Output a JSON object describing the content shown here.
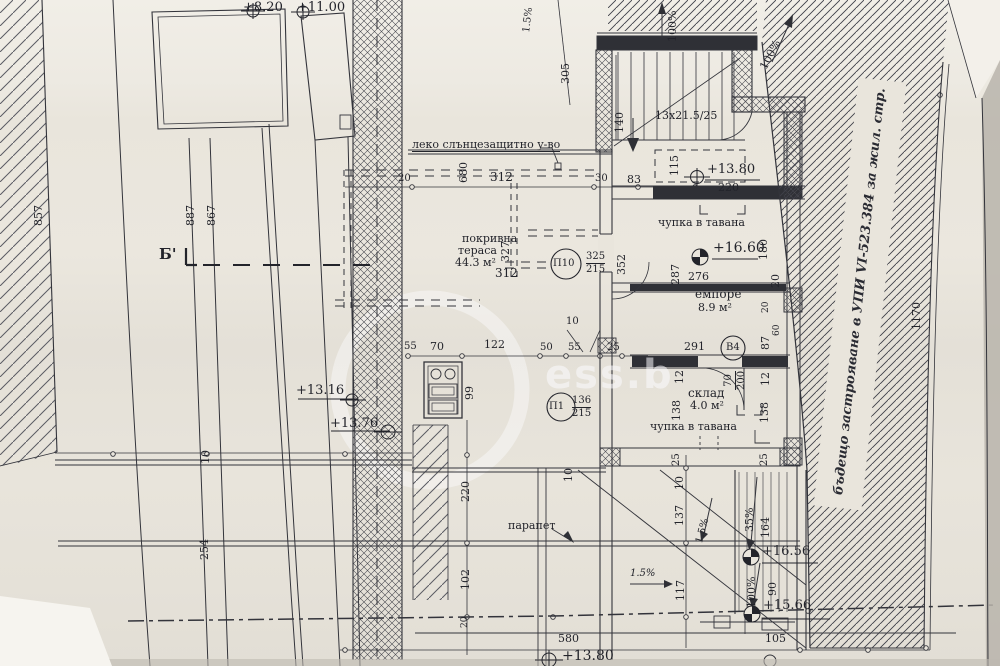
{
  "drawing": {
    "section_label": "Б'",
    "watermark": "ess.b",
    "notes": {
      "sunshade": "леко слънцезащитно у-во",
      "ceiling_bend_upper": "чупка в тавана",
      "ceiling_bend_lower": "чупка в тавана",
      "parapet": "парапет",
      "future_development": "бъдещо застрояване в УПИ VI-523.384 за жил. стр.",
      "stair_spec": "13x21.5/25"
    },
    "rooms": {
      "roof_terrace": {
        "name": "покривна",
        "name2": "тераса",
        "area": "44.3 м²"
      },
      "empore": {
        "name": "емпоре",
        "area": "8.9 м²"
      },
      "storage": {
        "name": "склад",
        "area": "4.0 м²"
      }
    },
    "levels": {
      "l_820": "+8.20",
      "l_1100": "+11.00",
      "l_1380_top": "+13.80",
      "l_1660": "+16.60",
      "l_1316": "+13.16",
      "l_1376": "+13.76",
      "l_1656": "+16.56",
      "l_1566": "+15.66",
      "l_1380_bottom": "+13.80"
    },
    "slopes": {
      "s100_a": "100%",
      "s100_b": "100%",
      "s15_top": "1.5%",
      "s15_mid": "1.5%",
      "s15_low": "1.5%",
      "s35": "35%",
      "s100_ramp": "100%"
    },
    "doors": {
      "p10": {
        "tag": "П10",
        "num": "325",
        "den": "215"
      },
      "p1": {
        "tag": "П1",
        "num": "136",
        "den": "215"
      },
      "v4": {
        "tag": "В4",
        "num": "70",
        "den": "200"
      }
    },
    "dims": {
      "d857": "857",
      "d887": "887",
      "d867": "867",
      "d10_left": "10",
      "d254": "254",
      "d305": "305",
      "d680": "680",
      "d140": "140",
      "d115": "115",
      "d20_wall": "20",
      "d312_top": "312",
      "d30": "30",
      "d83": "83",
      "d327": "327",
      "d352": "352",
      "d312_mid": "312",
      "d220_level": "220",
      "d287": "287",
      "d276": "276",
      "d180": "180",
      "d20_right": "20",
      "d291": "291",
      "d87": "87",
      "d20_col": "20",
      "d60": "60",
      "d12_left": "12",
      "d12_right": "12",
      "d138_left": "138",
      "d138_right": "138",
      "d25_wall_l": "25",
      "d25_wall_r": "25",
      "d55_a": "55",
      "d70": "70",
      "d122": "122",
      "d50": "50",
      "d55_b": "55",
      "d25_c": "25",
      "d10_fix": "10",
      "d99": "99",
      "d220_b": "220",
      "d102": "102",
      "d20_d": "20",
      "d10_b": "10",
      "d10_c": "10",
      "d137": "137",
      "d117": "117",
      "d164": "164",
      "d90": "90",
      "d105": "105",
      "d580": "580",
      "d1170": "1170"
    }
  }
}
